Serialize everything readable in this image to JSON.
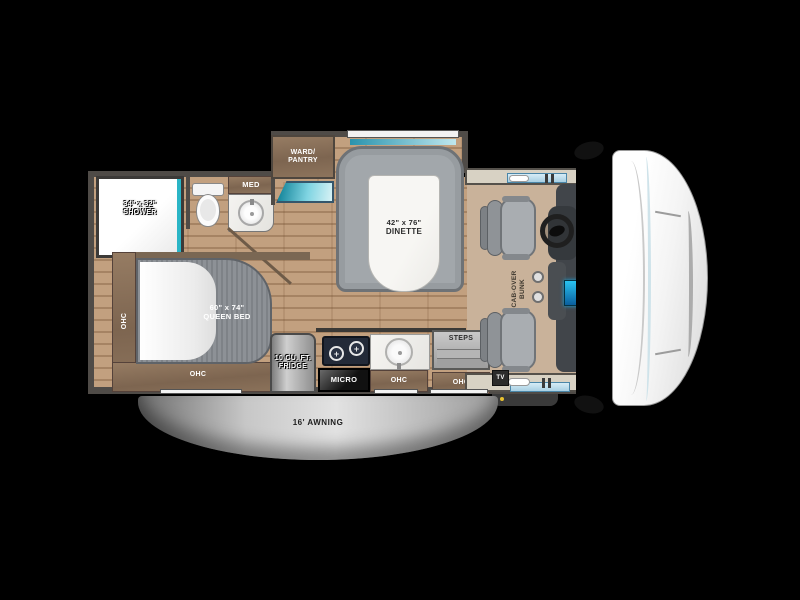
{
  "floorplan": {
    "bathroom": {
      "shower_size": "34\" x 32\"",
      "shower_name": "SHOWER",
      "med": "MED"
    },
    "storage": {
      "ward_line1": "WARD/",
      "ward_line2": "PANTRY",
      "ohc_left": "OHC",
      "ohc_bed": "OHC",
      "ohc_kitchen": "OHC",
      "ohc_entry": "OHC"
    },
    "dinette": {
      "size": "42\" x 76\"",
      "name": "DINETTE"
    },
    "bedroom": {
      "size": "60\" x 74\"",
      "name": "QUEEN BED"
    },
    "kitchen": {
      "fridge_line1": "10 CU. FT.",
      "fridge_line2": "FRIDGE",
      "micro": "MICRO",
      "burner_glyph": "+"
    },
    "entry": {
      "steps": "STEPS",
      "tv": "TV"
    },
    "cab": {
      "bunk_line1": "CAB-OVER",
      "bunk_line2": "BUNK"
    },
    "exterior": {
      "awning": "16' AWNING"
    }
  },
  "colors": {
    "background": "#000000",
    "accent_teal": "#2ab5c6",
    "wood_cabinet": "#8a7260",
    "floor_wood": "#c2a07f",
    "bed_gray": "#85898e",
    "booth_gray": "#a2a7ab",
    "awning_gray": "#bcbcbc",
    "cab_floor_tan": "#c9b29a",
    "console_screen_blue": "#1aa8e0"
  }
}
